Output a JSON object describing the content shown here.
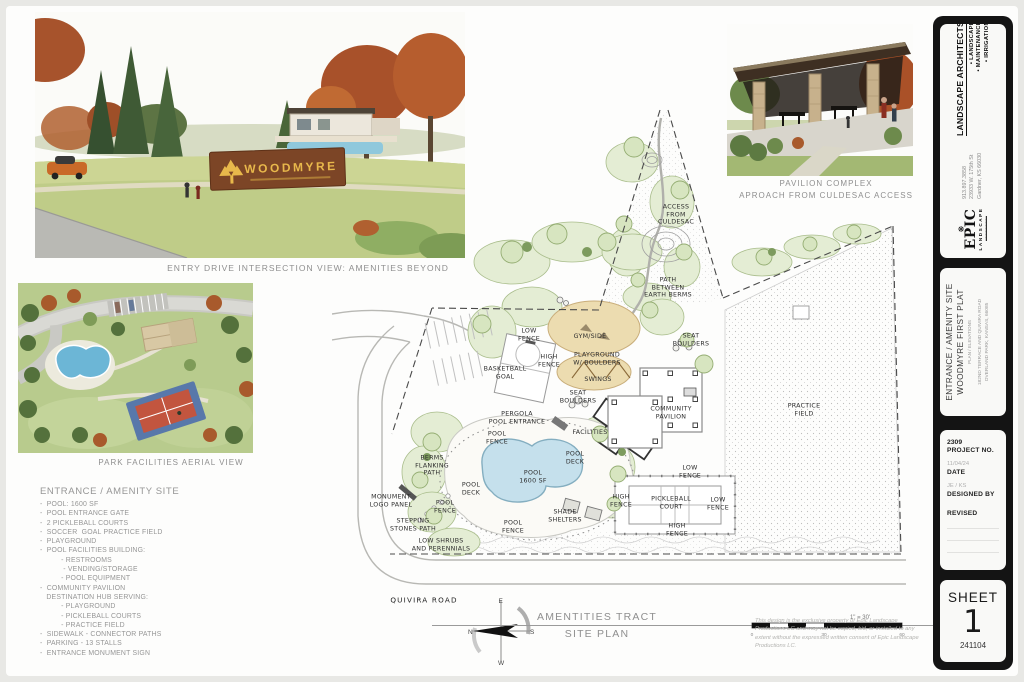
{
  "captions": {
    "entry_view": "ENTRY DRIVE INTERSECTION VIEW: AMENITIES BEYOND",
    "aerial_view": "PARK FACILITIES AERIAL VIEW",
    "pavilion_line1": "PAVILION COMPLEX",
    "pavilion_line2": "APROACH FROM CULDESAC ACCESS"
  },
  "entry_render": {
    "sign_text": "WOODMYRE"
  },
  "amenity_list": {
    "title": "ENTRANCE / AMENITY SITE",
    "body": "-  POOL: 1600 SF\n-  POOL ENTRANCE GATE\n-  2 PICKLEBALL COURTS\n-  SOCCER  GOAL PRACTICE FIELD\n-  PLAYGROUND\n-  POOL FACILITIES BUILDING:\n          - RESTROOMS\n           - VENDING/STORAGE\n          - POOL EQUIPMENT\n-  COMMUNITY PAVILION\n   DESTINATION HUB SERVING:\n          - PLAYGROUND\n          - PICKLEBALL COURTS\n          - PRACTICE FIELD\n-  SIDEWALK - CONNECTOR PATHS\n-  PARKING - 13 STALLS\n-  ENTRANCE MONUMENT SIGN"
  },
  "plan": {
    "labels": [
      "ACCESS\nFROM\nCULDESAC",
      "PATH\nBETWEEN\nEARTH BERMS",
      "LOW\nFENCE",
      "HIGH\nFENCE",
      "BASKETBALL\nGOAL",
      "GYM/SIDE",
      "PLAYGROUND\nW/ BOULDERS",
      "SWINGS",
      "SEAT\nBOULDERS",
      "SEAT\nBOULDERS",
      "COMMUNITY\nPAVILION",
      "PERGOLA\nPOOL ENTRANCE",
      "FACILITIES",
      "POOL\nFENCE",
      "POOL\nDECK",
      "POOL\n1600 SF",
      "POOL\nDECK",
      "BERMS\nFLANKING\nPATH",
      "MONUMENT\nLOGO PANEL",
      "POOL\nFENCE",
      "STEPPING\nSTONES PATH",
      "LOW SHRUBS\nAND PERENNIALS",
      "POOL\nFENCE",
      "SHADE\nSHELTERS",
      "HIGH\nFENCE",
      "LOW\nFENCE",
      "PICKLEBALL\nCOURT",
      "LOW\nFENCE",
      "HIGH\nFENCE",
      "PRACTICE\nFIELD",
      "QUIVIRA ROAD"
    ]
  },
  "footer": {
    "tract_title": "AMENTITIES TRACT",
    "tract_subtitle": "SITE PLAN",
    "scale_label": "1\" = 30'",
    "scale_ticks": [
      "0",
      "30",
      "60"
    ],
    "compass": {
      "n": "N",
      "s": "S",
      "e": "E",
      "w": "W"
    }
  },
  "titleblock": {
    "firm_name": "LANDSCAPE ARCHITECTS",
    "services": [
      "• LANDSCAPE",
      "• MAINTENANCE",
      "• IRRIGATION"
    ],
    "phone": "913.897.3858",
    "address1": "23933 W. 175th St",
    "address2": "Gardner, KS 66030",
    "logo_leaf": "❋",
    "logo_name": "EPIC",
    "logo_sub": "LANDSCAPE",
    "logo_bars": "▬▬▬▬▬▬▬▬",
    "project_title1": "ENTRANCE / AMENITY SITE",
    "project_title2": "WOODMYRE FIRST PLAT",
    "project_subtitle": "PLAN / ELEVATIONS",
    "project_addr1": "182ND TERRACE AND QUIVIRA ROAD",
    "project_addr2": "OVERLAND PARK, KANSAS, 66085",
    "project_no_value": "2309",
    "project_no_label": "PROJECT NO.",
    "date_value": "11/04/24",
    "date_label": "DATE",
    "designed_value": "JE / KS",
    "designed_label": "DESIGNED BY",
    "revised_label": "REVISED",
    "sheet_label": "SHEET",
    "sheet_number": "1",
    "sheet_code": "241104"
  },
  "legal": "This design is the exclusive property of Epic Landscape Productions LC and may not be copied, bid, or installed to any extent without the expressed written consent of Epic Landscape Productions LC."
}
